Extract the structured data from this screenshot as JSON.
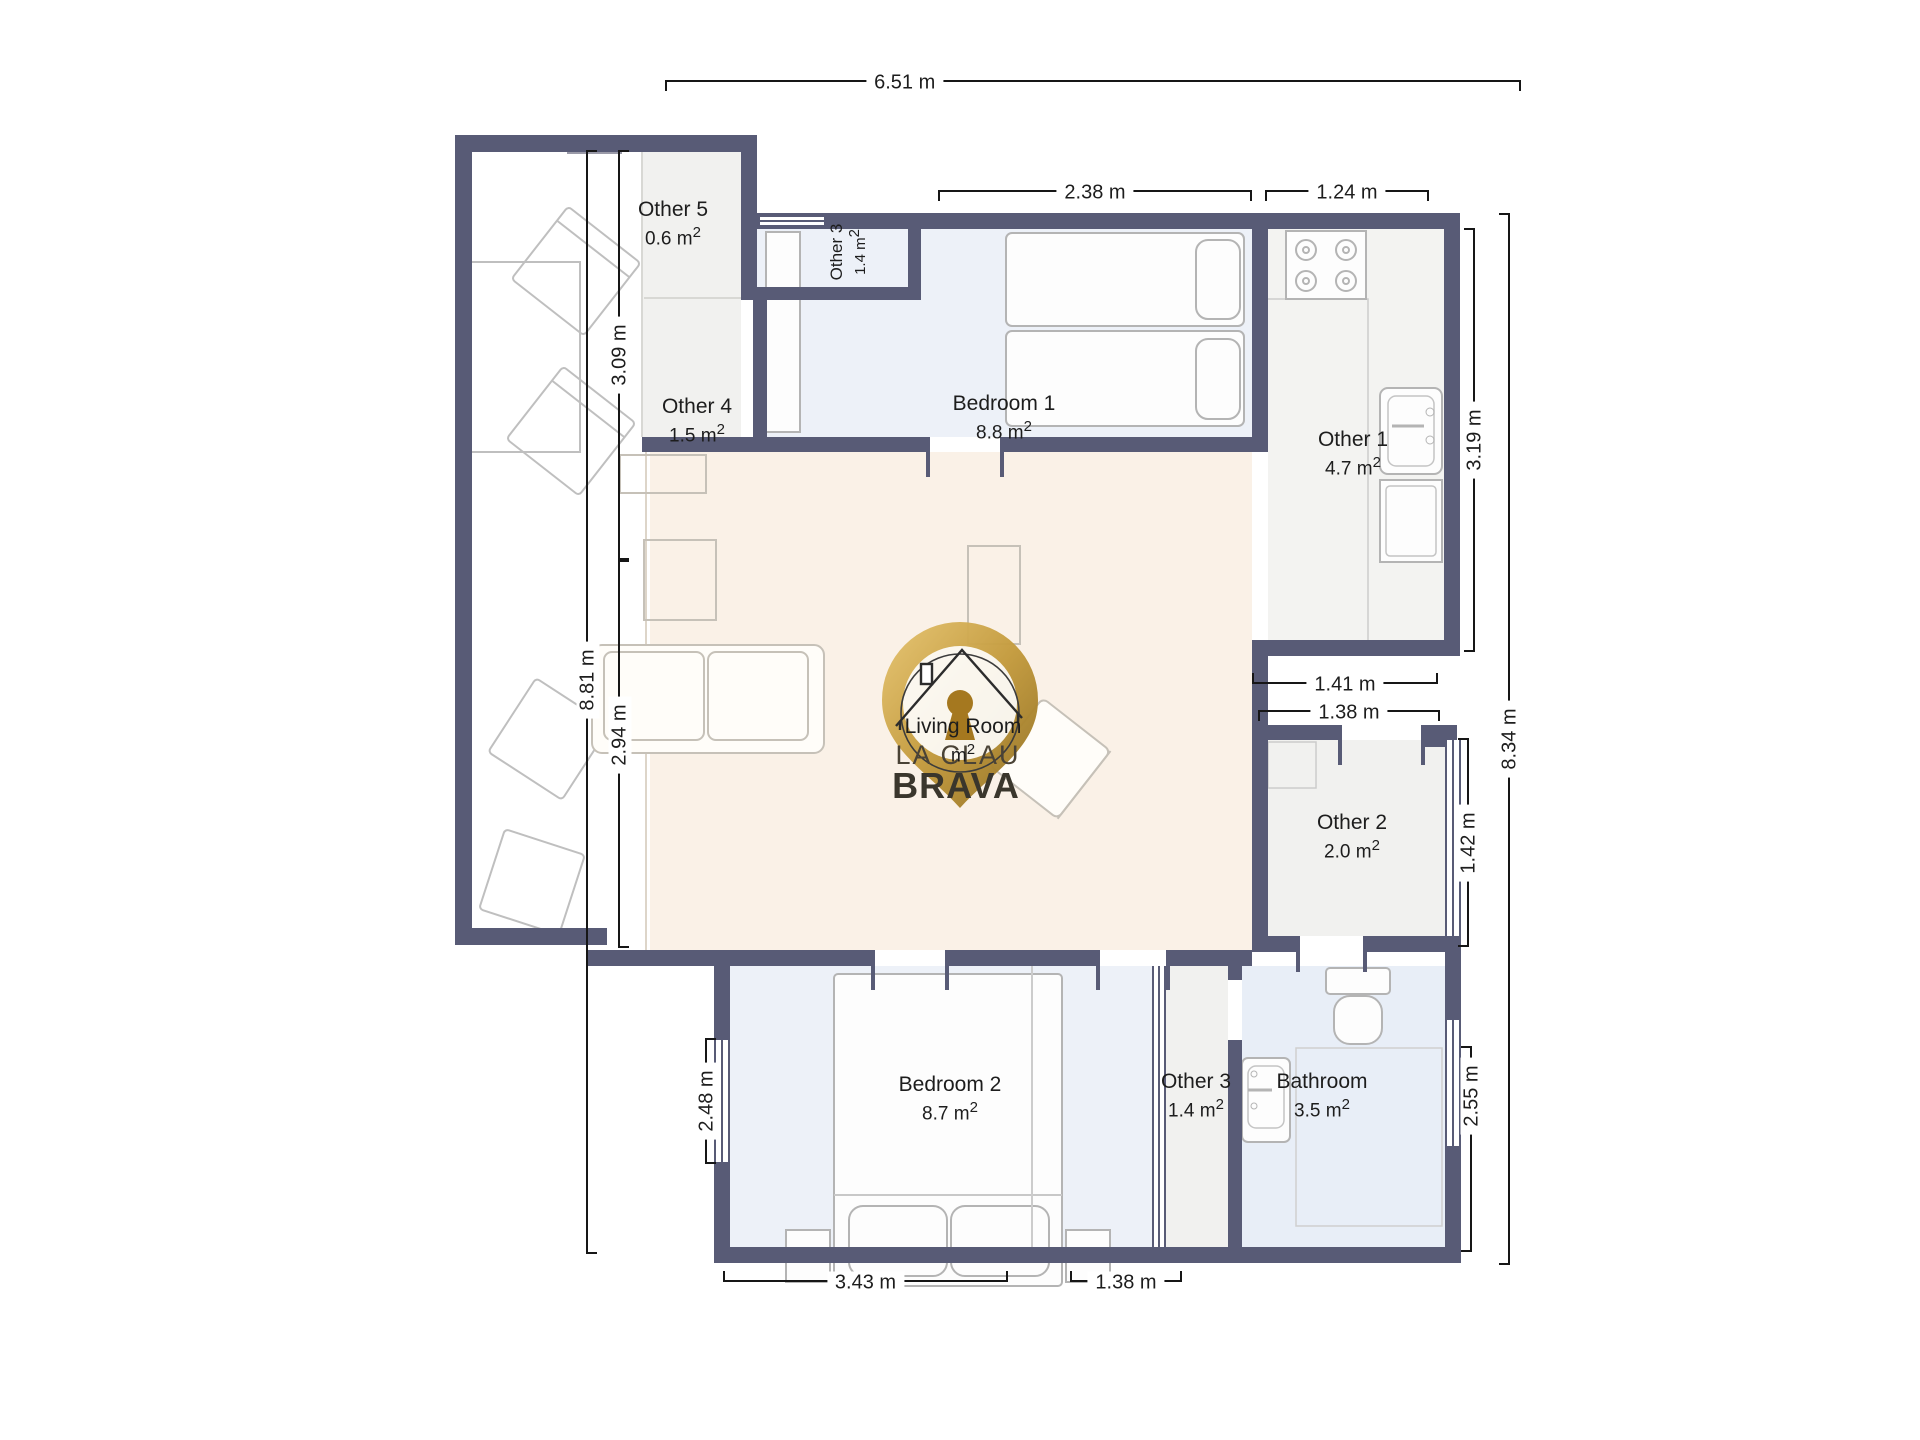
{
  "logo": {
    "line1": "LA CLAU",
    "line2": "BRAVA"
  },
  "rooms": {
    "other5": {
      "name": "Other 5",
      "area": "0.6 m",
      "sup": "2"
    },
    "other3_top": {
      "name": "Other 3",
      "area": "1.4 m",
      "sup": "2"
    },
    "bedroom1": {
      "name": "Bedroom 1",
      "area": "8.8 m",
      "sup": "2"
    },
    "other1": {
      "name": "Other 1",
      "area": "4.7 m",
      "sup": "2"
    },
    "other4": {
      "name": "Other 4",
      "area": "1.5 m",
      "sup": "2"
    },
    "living": {
      "name": "Living Room",
      "area": "m",
      "sup": "2"
    },
    "other2": {
      "name": "Other 2",
      "area": "2.0 m",
      "sup": "2"
    },
    "bedroom2": {
      "name": "Bedroom 2",
      "area": "8.7 m",
      "sup": "2"
    },
    "other3_bottom": {
      "name": "Other 3",
      "area": "1.4 m",
      "sup": "2"
    },
    "bathroom": {
      "name": "Bathroom",
      "area": "3.5 m",
      "sup": "2"
    }
  },
  "dimensions": {
    "top": "6.51 m",
    "bedroom1_top": "2.38 m",
    "kitchen_top": "1.24 m",
    "terrace_upper": "3.09 m",
    "left_total": "8.81 m",
    "living_left": "2.94 m",
    "kitchen_right": "3.19 m",
    "hall_upper": "1.41 m",
    "hall_lower": "1.38 m",
    "right_total": "8.34 m",
    "other2_right": "1.42 m",
    "bedroom2_left": "2.48 m",
    "bathroom_right": "2.55 m",
    "bedroom2_bottom": "3.43 m",
    "bathroom_bottom": "1.38 m"
  },
  "colors": {
    "wall": "#585b76",
    "bedroom_floor": "#edf1f8",
    "living_floor": "#faf1e7",
    "utility_floor": "#f1f1ef",
    "bathroom_floor": "#e8eef7",
    "logo_gold": "#c9a34a",
    "dimension_line": "#161616"
  }
}
